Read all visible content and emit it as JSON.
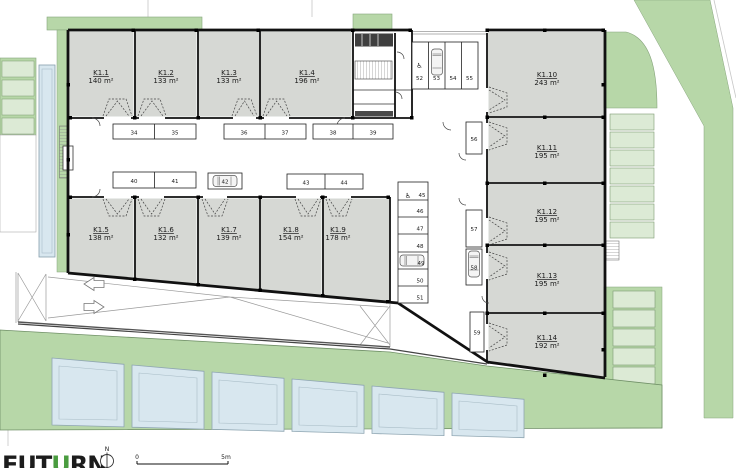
{
  "plan": {
    "units": [
      {
        "id": "K1.1",
        "area": "140 m²"
      },
      {
        "id": "K1.2",
        "area": "133 m²"
      },
      {
        "id": "K1.3",
        "area": "133 m²"
      },
      {
        "id": "K1.4",
        "area": "196 m²"
      },
      {
        "id": "K1.5",
        "area": "138 m²"
      },
      {
        "id": "K1.6",
        "area": "132 m²"
      },
      {
        "id": "K1.7",
        "area": "139 m²"
      },
      {
        "id": "K1.8",
        "area": "154 m²"
      },
      {
        "id": "K1.9",
        "area": "178 m²"
      },
      {
        "id": "K1.10",
        "area": "243 m²"
      },
      {
        "id": "K1.11",
        "area": "195 m²"
      },
      {
        "id": "K1.12",
        "area": "195 m²"
      },
      {
        "id": "K1.13",
        "area": "195 m²"
      },
      {
        "id": "K1.14",
        "area": "192 m²"
      }
    ],
    "parking": {
      "corridor_top": [
        "34",
        "35",
        "36",
        "37",
        "38",
        "39"
      ],
      "corridor_bottom": [
        "40",
        "41",
        "42",
        "43",
        "44"
      ],
      "north_stalls": [
        "52",
        "53",
        "54",
        "55"
      ],
      "court_column": [
        "45",
        "46",
        "47",
        "48",
        "49",
        "50",
        "51"
      ],
      "east_column": [
        "56",
        "57",
        "58",
        "59"
      ]
    },
    "icons": {
      "wheelchair": "♿"
    }
  },
  "footer": {
    "logo_prefix": "FUT",
    "logo_accent": "U",
    "logo_suffix": "RN",
    "north_label": "N",
    "scale_zero": "0",
    "scale_five": "5m"
  },
  "colors": {
    "landscape_green": "#b7d7a8",
    "planting_light_green": "#dcead5",
    "glass_blue": "#d8e7ef",
    "unit_fill_gray": "#d6d8d4",
    "wall_black": "#111111",
    "logo_accent_green": "#4a9c3f"
  }
}
